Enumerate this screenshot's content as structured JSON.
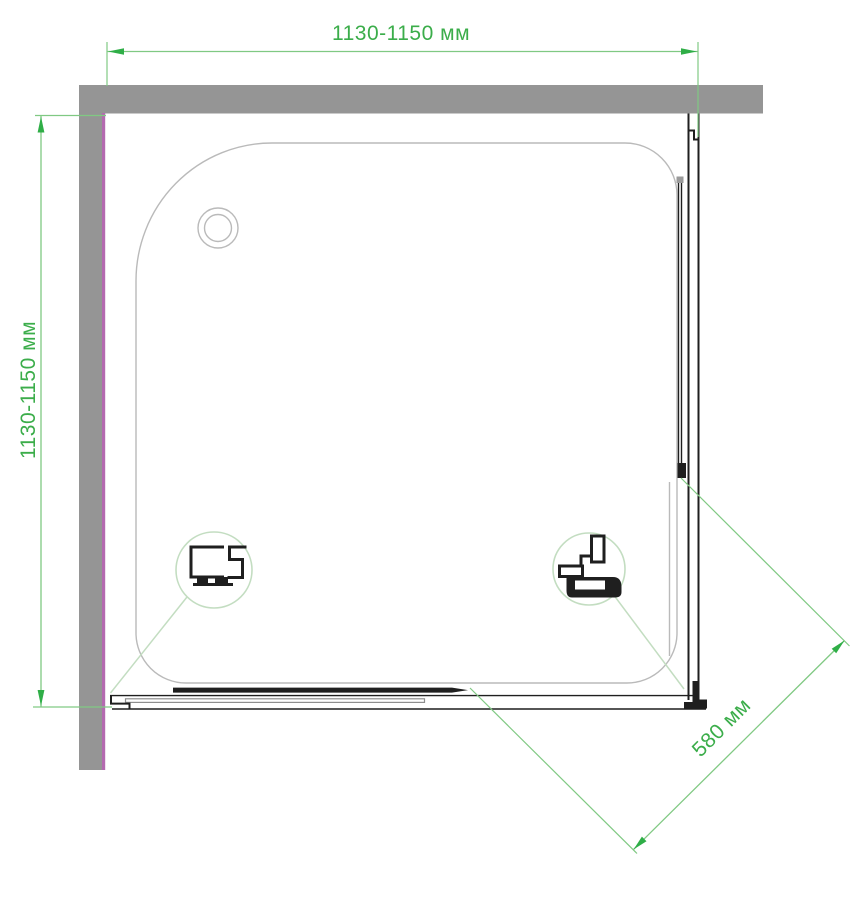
{
  "drawing": {
    "dimensions": {
      "top": {
        "label": "1130-1150 мм"
      },
      "left": {
        "label": "1130-1150 мм"
      },
      "diagonal": {
        "label": "580 мм"
      }
    },
    "details": {
      "left_callout": {
        "icon": "wall-profile-icon"
      },
      "right_callout": {
        "icon": "corner-roller-profile-icon"
      }
    },
    "colors": {
      "dimension_text": "#3bad4a",
      "dimension_line": "#80c983",
      "dimension_arrow": "#2fae47",
      "leader": "#c3ddc1",
      "wall": "#959595",
      "wall_inner_edge": "#b46ab0",
      "tray_outline": "#bababa",
      "frame": "#1f1f1f",
      "rail": "#8e8e8e",
      "background": "#ffffff"
    }
  }
}
